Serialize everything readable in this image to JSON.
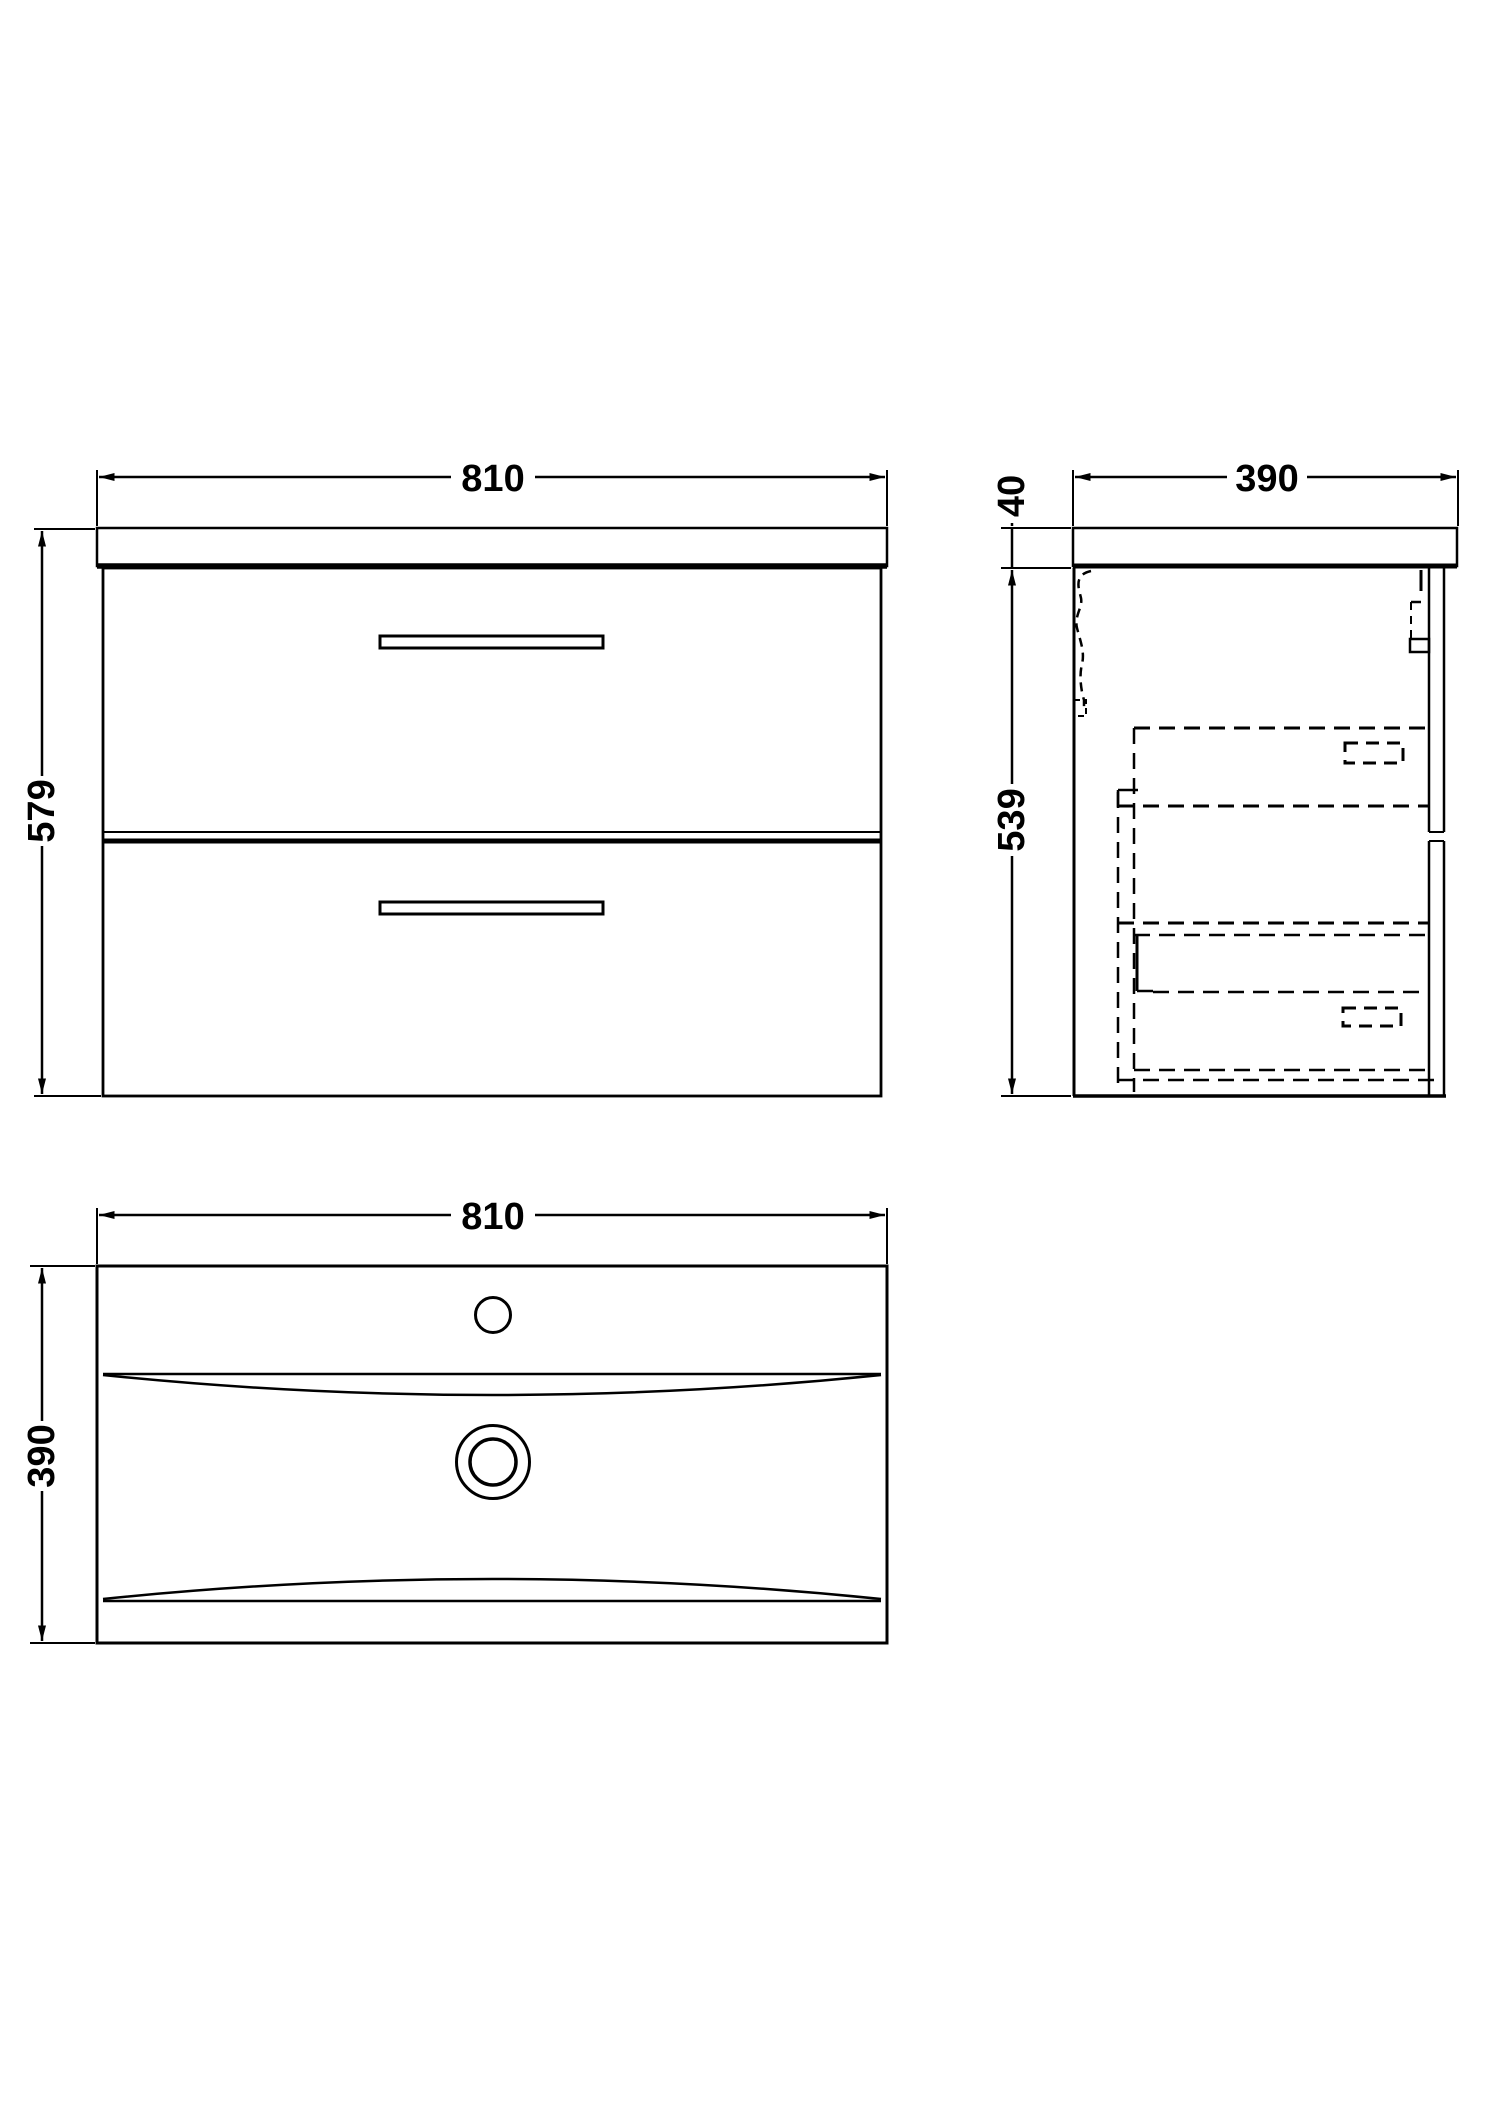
{
  "drawing": {
    "description": "Wall-hung two-drawer vanity unit with basin - dimensioned technical drawing, three orthographic views",
    "front_view": {
      "name": "front elevation",
      "width_mm": "810",
      "height_mm": "579"
    },
    "side_view": {
      "name": "side section",
      "depth_mm": "390",
      "worktop_thickness_mm": "40",
      "cabinet_height_mm": "539"
    },
    "plan_view": {
      "name": "basin plan",
      "width_mm": "810",
      "depth_mm": "390"
    }
  },
  "colors": {
    "line": "#000000",
    "background": "#ffffff"
  }
}
